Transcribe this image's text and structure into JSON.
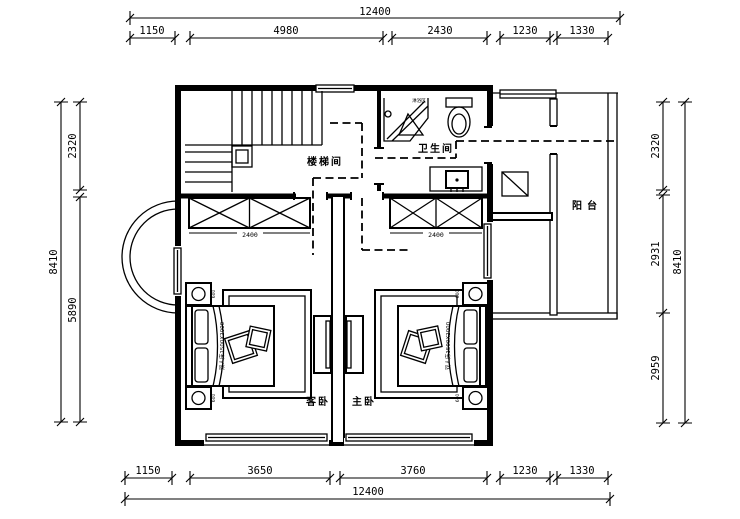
{
  "drawing": {
    "rooms": {
      "stairwell": "楼梯间",
      "bathroom": "卫生间",
      "shower_area": "淋浴区",
      "balcony": "阳台",
      "guest_bedroom": "客卧",
      "master_bedroom": "主卧"
    },
    "furniture": {
      "bed_left": "双人床1500X2000",
      "bed_right": "双人床1500X2000",
      "wardrobe_left": "2400",
      "wardrobe_right": "2400",
      "nightstand": "600"
    },
    "dims": {
      "top": {
        "overall": "12400",
        "seg": [
          "1150",
          "4980",
          "2430",
          "1230",
          "1330"
        ]
      },
      "bottom": {
        "overall": "12400",
        "seg": [
          "1150",
          "3650",
          "3760",
          "1230",
          "1330"
        ]
      },
      "left": {
        "overall": "8410",
        "seg": [
          "2320",
          "5890"
        ]
      },
      "right": {
        "overall": "8410",
        "seg": [
          "2320",
          "2931",
          "2959"
        ]
      }
    }
  }
}
